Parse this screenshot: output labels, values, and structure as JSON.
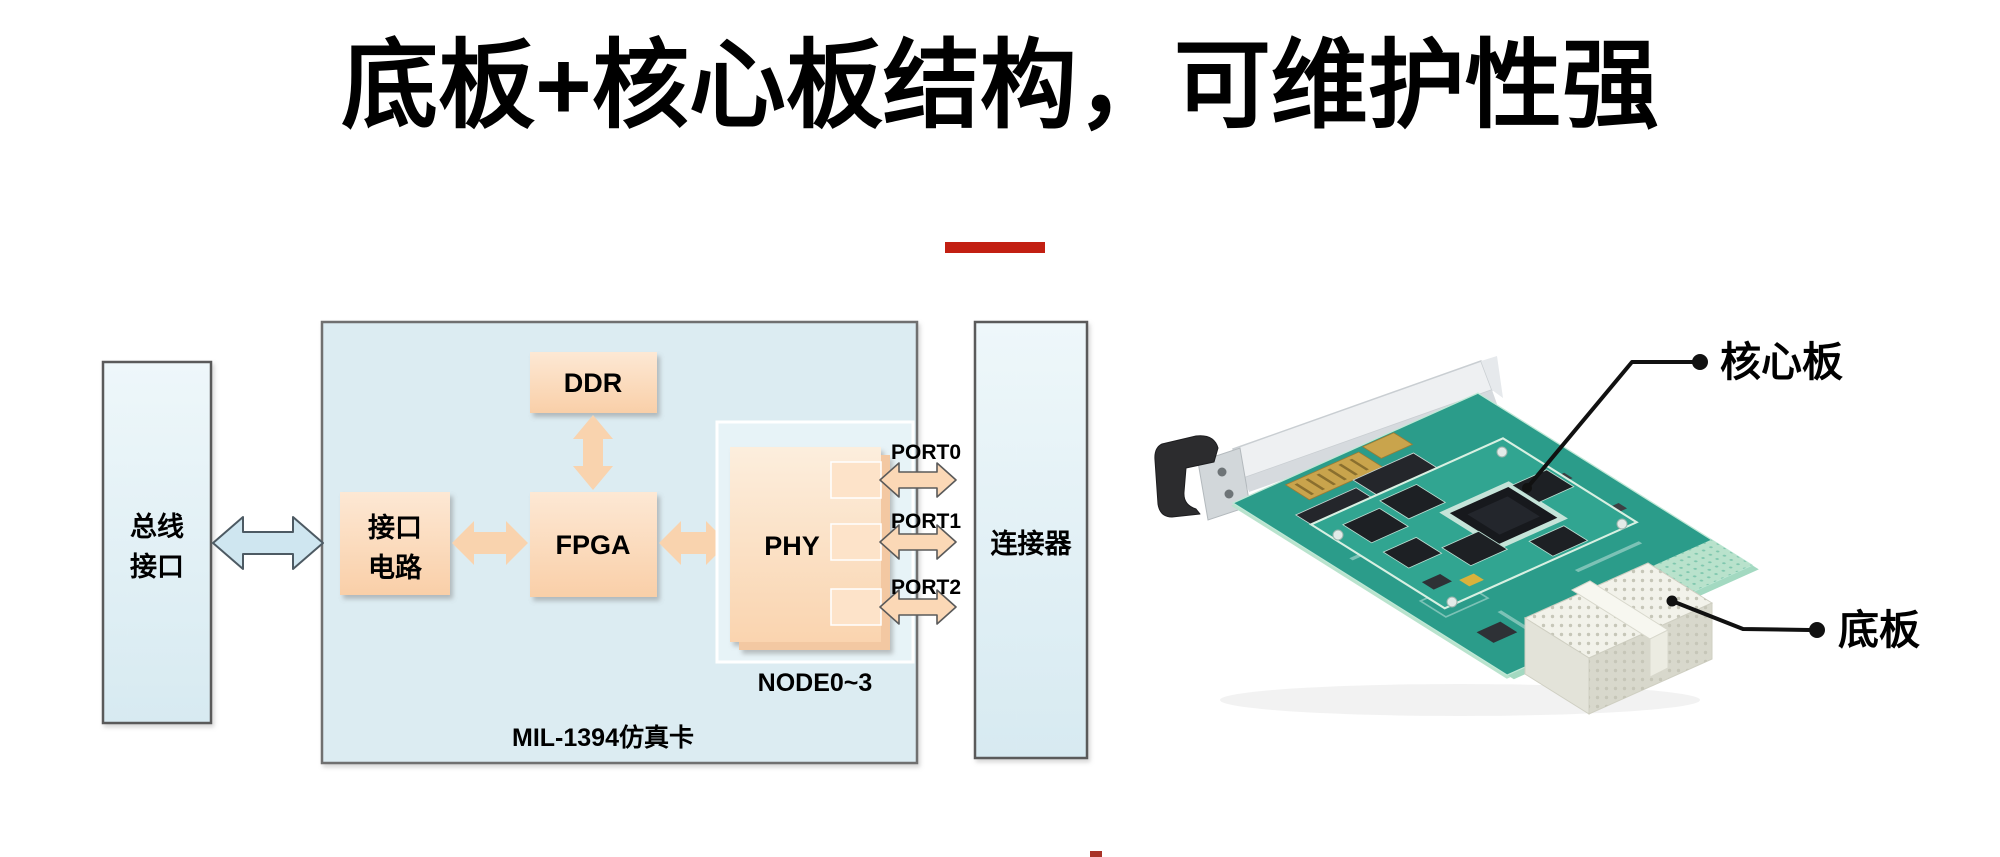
{
  "title": {
    "text": "底板+核心板结构，可维护性强"
  },
  "divider": {
    "color": "#c21f12"
  },
  "bottom_mark": {
    "color": "#a93328"
  },
  "diagram": {
    "bus_box": {
      "line1": "总线",
      "line2": "接口"
    },
    "card_box": {
      "label": "MIL-1394仿真卡"
    },
    "interface_circuit": {
      "line1": "接口",
      "line2": "电路"
    },
    "ddr": {
      "label": "DDR"
    },
    "fpga": {
      "label": "FPGA"
    },
    "phy": {
      "label": "PHY"
    },
    "node_group": {
      "label": "NODE0~3"
    },
    "ports": [
      {
        "label": "PORT0"
      },
      {
        "label": "PORT1"
      },
      {
        "label": "PORT2"
      }
    ],
    "connector_box": {
      "label": "连接器"
    }
  },
  "photo": {
    "core_board_label": "核心板",
    "base_board_label": "底板"
  },
  "colors": {
    "box_blue_fill": "#dcecf2",
    "box_peach_fill": "#fbd5b2",
    "arrow_blue_fill": "#cfe6f0",
    "outline_gray": "#5a5a5a",
    "pcb_green": "#2b9c8a",
    "core_green": "#31a591",
    "chip_black": "#1d2024",
    "connector_white": "#f2f2ea",
    "bracket_silver": "#eef0f2",
    "callout_black": "#111111"
  }
}
